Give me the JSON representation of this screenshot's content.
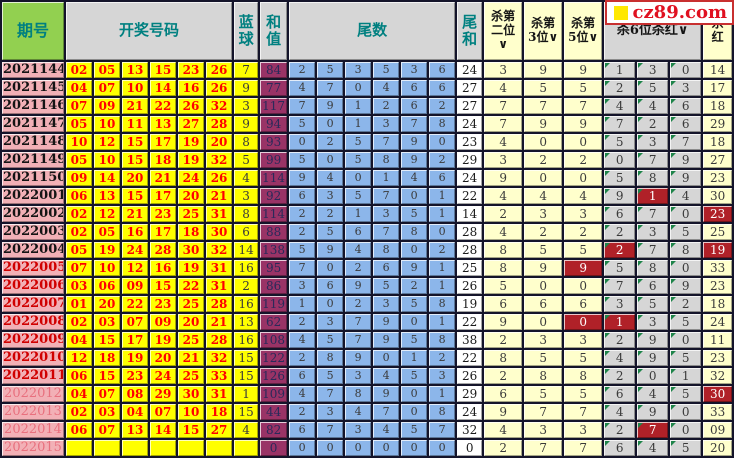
{
  "logo": {
    "text": "cz89.com",
    "square_color": "#FFE800",
    "text_color": "#E01020"
  },
  "colors": {
    "period_bg": "#F2B0B6",
    "number_bg": "#FFFF00",
    "number_text": "#FF0000",
    "sum_bg": "#993366",
    "tail_bg": "#8CB6EA",
    "kill_yellow_bg": "#FFFFCC",
    "kill_gray_bg": "#D6D6D6",
    "hit_bg": "#B02128",
    "header_green": "#92D050",
    "header_gray": "#D6D6D6",
    "header_text": "#008080"
  },
  "table": {
    "header": {
      "period": "期号",
      "numbers": "开奖号码",
      "blue": "蓝\n球",
      "sum": "和\n值",
      "tails": "尾数",
      "tail_sum": "尾\n和",
      "kill2": "杀第\n二位\n∨",
      "kill3": "杀第\n3位∨",
      "kill5": "杀第\n5位∨",
      "kill6": "杀6位杀红∨",
      "kill_red": "杀\n红"
    },
    "rows": [
      {
        "period": "2021144",
        "period_style": "past",
        "nums": [
          "02",
          "05",
          "13",
          "15",
          "23",
          "26"
        ],
        "blue": "7",
        "sum": "84",
        "tails": [
          "2",
          "5",
          "3",
          "5",
          "3",
          "6"
        ],
        "tail_sum": "24",
        "kill2": "3",
        "kill3": "9",
        "kill5": "9",
        "kill5_hit": false,
        "kill6": [
          "1",
          "3",
          "0"
        ],
        "kill6_hit": [
          false,
          false,
          false
        ],
        "kill_red": "14",
        "kill_red_hit": false
      },
      {
        "period": "2021145",
        "period_style": "past",
        "nums": [
          "04",
          "07",
          "10",
          "14",
          "16",
          "26"
        ],
        "blue": "9",
        "sum": "77",
        "tails": [
          "4",
          "7",
          "0",
          "4",
          "6",
          "6"
        ],
        "tail_sum": "27",
        "kill2": "4",
        "kill3": "5",
        "kill5": "5",
        "kill5_hit": false,
        "kill6": [
          "2",
          "5",
          "3"
        ],
        "kill6_hit": [
          false,
          false,
          false
        ],
        "kill_red": "17",
        "kill_red_hit": false
      },
      {
        "period": "2021146",
        "period_style": "past",
        "nums": [
          "07",
          "09",
          "21",
          "22",
          "26",
          "32"
        ],
        "blue": "3",
        "sum": "117",
        "tails": [
          "7",
          "9",
          "1",
          "2",
          "6",
          "2"
        ],
        "tail_sum": "27",
        "kill2": "7",
        "kill3": "7",
        "kill5": "7",
        "kill5_hit": false,
        "kill6": [
          "4",
          "4",
          "6"
        ],
        "kill6_hit": [
          false,
          false,
          false
        ],
        "kill_red": "18",
        "kill_red_hit": false
      },
      {
        "period": "2021147",
        "period_style": "past",
        "nums": [
          "05",
          "10",
          "11",
          "13",
          "27",
          "28"
        ],
        "blue": "9",
        "sum": "94",
        "tails": [
          "5",
          "0",
          "1",
          "3",
          "7",
          "8"
        ],
        "tail_sum": "24",
        "kill2": "7",
        "kill3": "9",
        "kill5": "9",
        "kill5_hit": false,
        "kill6": [
          "7",
          "2",
          "6"
        ],
        "kill6_hit": [
          false,
          false,
          false
        ],
        "kill_red": "29",
        "kill_red_hit": false
      },
      {
        "period": "2021148",
        "period_style": "past",
        "nums": [
          "10",
          "12",
          "15",
          "17",
          "19",
          "20"
        ],
        "blue": "8",
        "sum": "93",
        "tails": [
          "0",
          "2",
          "5",
          "7",
          "9",
          "0"
        ],
        "tail_sum": "23",
        "kill2": "4",
        "kill3": "0",
        "kill5": "0",
        "kill5_hit": false,
        "kill6": [
          "5",
          "3",
          "7"
        ],
        "kill6_hit": [
          false,
          false,
          false
        ],
        "kill_red": "18",
        "kill_red_hit": false
      },
      {
        "period": "2021149",
        "period_style": "past",
        "nums": [
          "05",
          "10",
          "15",
          "18",
          "19",
          "32"
        ],
        "blue": "5",
        "sum": "99",
        "tails": [
          "5",
          "0",
          "5",
          "8",
          "9",
          "2"
        ],
        "tail_sum": "29",
        "kill2": "3",
        "kill3": "2",
        "kill5": "2",
        "kill5_hit": false,
        "kill6": [
          "0",
          "7",
          "9"
        ],
        "kill6_hit": [
          false,
          false,
          false
        ],
        "kill_red": "27",
        "kill_red_hit": false
      },
      {
        "period": "2021150",
        "period_style": "past",
        "nums": [
          "09",
          "14",
          "20",
          "21",
          "24",
          "26"
        ],
        "blue": "4",
        "sum": "114",
        "tails": [
          "9",
          "4",
          "0",
          "1",
          "4",
          "6"
        ],
        "tail_sum": "24",
        "kill2": "9",
        "kill3": "0",
        "kill5": "0",
        "kill5_hit": false,
        "kill6": [
          "5",
          "8",
          "9"
        ],
        "kill6_hit": [
          false,
          false,
          false
        ],
        "kill_red": "23",
        "kill_red_hit": false
      },
      {
        "period": "2022001",
        "period_style": "past",
        "nums": [
          "06",
          "13",
          "15",
          "17",
          "20",
          "21"
        ],
        "blue": "3",
        "sum": "92",
        "tails": [
          "6",
          "3",
          "5",
          "7",
          "0",
          "1"
        ],
        "tail_sum": "22",
        "kill2": "4",
        "kill3": "4",
        "kill5": "4",
        "kill5_hit": false,
        "kill6": [
          "9",
          "1",
          "4"
        ],
        "kill6_hit": [
          false,
          true,
          false
        ],
        "kill_red": "30",
        "kill_red_hit": false
      },
      {
        "period": "2022002",
        "period_style": "past",
        "nums": [
          "02",
          "12",
          "21",
          "23",
          "25",
          "31"
        ],
        "blue": "8",
        "sum": "114",
        "tails": [
          "2",
          "2",
          "1",
          "3",
          "5",
          "1"
        ],
        "tail_sum": "14",
        "kill2": "2",
        "kill3": "3",
        "kill5": "3",
        "kill5_hit": false,
        "kill6": [
          "6",
          "7",
          "0"
        ],
        "kill6_hit": [
          false,
          false,
          false
        ],
        "kill_red": "23",
        "kill_red_hit": true
      },
      {
        "period": "2022003",
        "period_style": "past",
        "nums": [
          "02",
          "05",
          "16",
          "17",
          "18",
          "30"
        ],
        "blue": "6",
        "sum": "88",
        "tails": [
          "2",
          "5",
          "6",
          "7",
          "8",
          "0"
        ],
        "tail_sum": "28",
        "kill2": "4",
        "kill3": "2",
        "kill5": "2",
        "kill5_hit": false,
        "kill6": [
          "2",
          "3",
          "5"
        ],
        "kill6_hit": [
          false,
          false,
          false
        ],
        "kill_red": "25",
        "kill_red_hit": false
      },
      {
        "period": "2022004",
        "period_style": "past",
        "nums": [
          "05",
          "19",
          "24",
          "28",
          "30",
          "32"
        ],
        "blue": "14",
        "sum": "138",
        "tails": [
          "5",
          "9",
          "4",
          "8",
          "0",
          "2"
        ],
        "tail_sum": "28",
        "kill2": "8",
        "kill3": "5",
        "kill5": "5",
        "kill5_hit": false,
        "kill6": [
          "2",
          "7",
          "8"
        ],
        "kill6_hit": [
          true,
          false,
          false
        ],
        "kill_red": "19",
        "kill_red_hit": true
      },
      {
        "period": "2022005",
        "period_style": "recent",
        "nums": [
          "07",
          "10",
          "12",
          "16",
          "19",
          "31"
        ],
        "blue": "16",
        "sum": "95",
        "tails": [
          "7",
          "0",
          "2",
          "6",
          "9",
          "1"
        ],
        "tail_sum": "25",
        "kill2": "8",
        "kill3": "9",
        "kill5": "9",
        "kill5_hit": true,
        "kill6": [
          "5",
          "8",
          "0"
        ],
        "kill6_hit": [
          false,
          false,
          false
        ],
        "kill_red": "33",
        "kill_red_hit": false
      },
      {
        "period": "2022006",
        "period_style": "recent",
        "nums": [
          "03",
          "06",
          "09",
          "15",
          "22",
          "31"
        ],
        "blue": "2",
        "sum": "86",
        "tails": [
          "3",
          "6",
          "9",
          "5",
          "2",
          "1"
        ],
        "tail_sum": "26",
        "kill2": "5",
        "kill3": "0",
        "kill5": "0",
        "kill5_hit": false,
        "kill6": [
          "7",
          "6",
          "9"
        ],
        "kill6_hit": [
          false,
          false,
          false
        ],
        "kill_red": "23",
        "kill_red_hit": false
      },
      {
        "period": "2022007",
        "period_style": "recent",
        "nums": [
          "01",
          "20",
          "22",
          "23",
          "25",
          "28"
        ],
        "blue": "16",
        "sum": "119",
        "tails": [
          "1",
          "0",
          "2",
          "3",
          "5",
          "8"
        ],
        "tail_sum": "19",
        "kill2": "6",
        "kill3": "6",
        "kill5": "6",
        "kill5_hit": false,
        "kill6": [
          "3",
          "5",
          "2"
        ],
        "kill6_hit": [
          false,
          false,
          false
        ],
        "kill_red": "18",
        "kill_red_hit": false
      },
      {
        "period": "2022008",
        "period_style": "recent",
        "nums": [
          "02",
          "03",
          "07",
          "09",
          "20",
          "21"
        ],
        "blue": "13",
        "sum": "62",
        "tails": [
          "2",
          "3",
          "7",
          "9",
          "0",
          "1"
        ],
        "tail_sum": "22",
        "kill2": "9",
        "kill3": "0",
        "kill5": "0",
        "kill5_hit": true,
        "kill6": [
          "1",
          "3",
          "5"
        ],
        "kill6_hit": [
          true,
          false,
          false
        ],
        "kill_red": "24",
        "kill_red_hit": false
      },
      {
        "period": "2022009",
        "period_style": "recent",
        "nums": [
          "04",
          "15",
          "17",
          "19",
          "25",
          "28"
        ],
        "blue": "16",
        "sum": "108",
        "tails": [
          "4",
          "5",
          "7",
          "9",
          "5",
          "8"
        ],
        "tail_sum": "38",
        "kill2": "2",
        "kill3": "3",
        "kill5": "3",
        "kill5_hit": false,
        "kill6": [
          "2",
          "9",
          "0"
        ],
        "kill6_hit": [
          false,
          false,
          false
        ],
        "kill_red": "11",
        "kill_red_hit": false
      },
      {
        "period": "2022010",
        "period_style": "recent",
        "nums": [
          "12",
          "18",
          "19",
          "20",
          "21",
          "32"
        ],
        "blue": "15",
        "sum": "122",
        "tails": [
          "2",
          "8",
          "9",
          "0",
          "1",
          "2"
        ],
        "tail_sum": "22",
        "kill2": "8",
        "kill3": "5",
        "kill5": "5",
        "kill5_hit": false,
        "kill6": [
          "4",
          "9",
          "5"
        ],
        "kill6_hit": [
          false,
          false,
          false
        ],
        "kill_red": "23",
        "kill_red_hit": false
      },
      {
        "period": "2022011",
        "period_style": "recent",
        "nums": [
          "06",
          "15",
          "23",
          "24",
          "25",
          "33"
        ],
        "blue": "15",
        "sum": "126",
        "tails": [
          "6",
          "5",
          "3",
          "4",
          "5",
          "3"
        ],
        "tail_sum": "26",
        "kill2": "2",
        "kill3": "8",
        "kill5": "8",
        "kill5_hit": false,
        "kill6": [
          "2",
          "0",
          "1"
        ],
        "kill6_hit": [
          false,
          false,
          false
        ],
        "kill_red": "32",
        "kill_red_hit": false
      },
      {
        "period": "2022012",
        "period_style": "future",
        "nums": [
          "04",
          "07",
          "08",
          "29",
          "30",
          "31"
        ],
        "blue": "1",
        "sum": "109",
        "tails": [
          "4",
          "7",
          "8",
          "9",
          "0",
          "1"
        ],
        "tail_sum": "29",
        "kill2": "6",
        "kill3": "5",
        "kill5": "5",
        "kill5_hit": false,
        "kill6": [
          "6",
          "4",
          "5"
        ],
        "kill6_hit": [
          false,
          false,
          false
        ],
        "kill_red": "30",
        "kill_red_hit": true
      },
      {
        "period": "2022013",
        "period_style": "future",
        "nums": [
          "02",
          "03",
          "04",
          "07",
          "10",
          "18"
        ],
        "blue": "15",
        "sum": "44",
        "tails": [
          "2",
          "3",
          "4",
          "7",
          "0",
          "8"
        ],
        "tail_sum": "24",
        "kill2": "9",
        "kill3": "7",
        "kill5": "7",
        "kill5_hit": false,
        "kill6": [
          "4",
          "9",
          "0"
        ],
        "kill6_hit": [
          false,
          false,
          false
        ],
        "kill_red": "33",
        "kill_red_hit": false
      },
      {
        "period": "2022014",
        "period_style": "future",
        "nums": [
          "06",
          "07",
          "13",
          "14",
          "15",
          "27"
        ],
        "blue": "4",
        "sum": "82",
        "tails": [
          "6",
          "7",
          "3",
          "4",
          "5",
          "7"
        ],
        "tail_sum": "32",
        "kill2": "4",
        "kill3": "3",
        "kill5": "3",
        "kill5_hit": false,
        "kill6": [
          "2",
          "7",
          "0"
        ],
        "kill6_hit": [
          false,
          true,
          false
        ],
        "kill_red": "09",
        "kill_red_hit": false
      },
      {
        "period": "2022015",
        "period_style": "future",
        "nums": [
          "",
          "",
          "",
          "",
          "",
          ""
        ],
        "blue": "",
        "sum": "0",
        "tails": [
          "0",
          "0",
          "0",
          "0",
          "0",
          "0"
        ],
        "tail_sum": "0",
        "kill2": "2",
        "kill3": "7",
        "kill5": "7",
        "kill5_hit": false,
        "kill6": [
          "6",
          "4",
          "5"
        ],
        "kill6_hit": [
          false,
          false,
          false
        ],
        "kill_red": "20",
        "kill_red_hit": false
      }
    ]
  }
}
